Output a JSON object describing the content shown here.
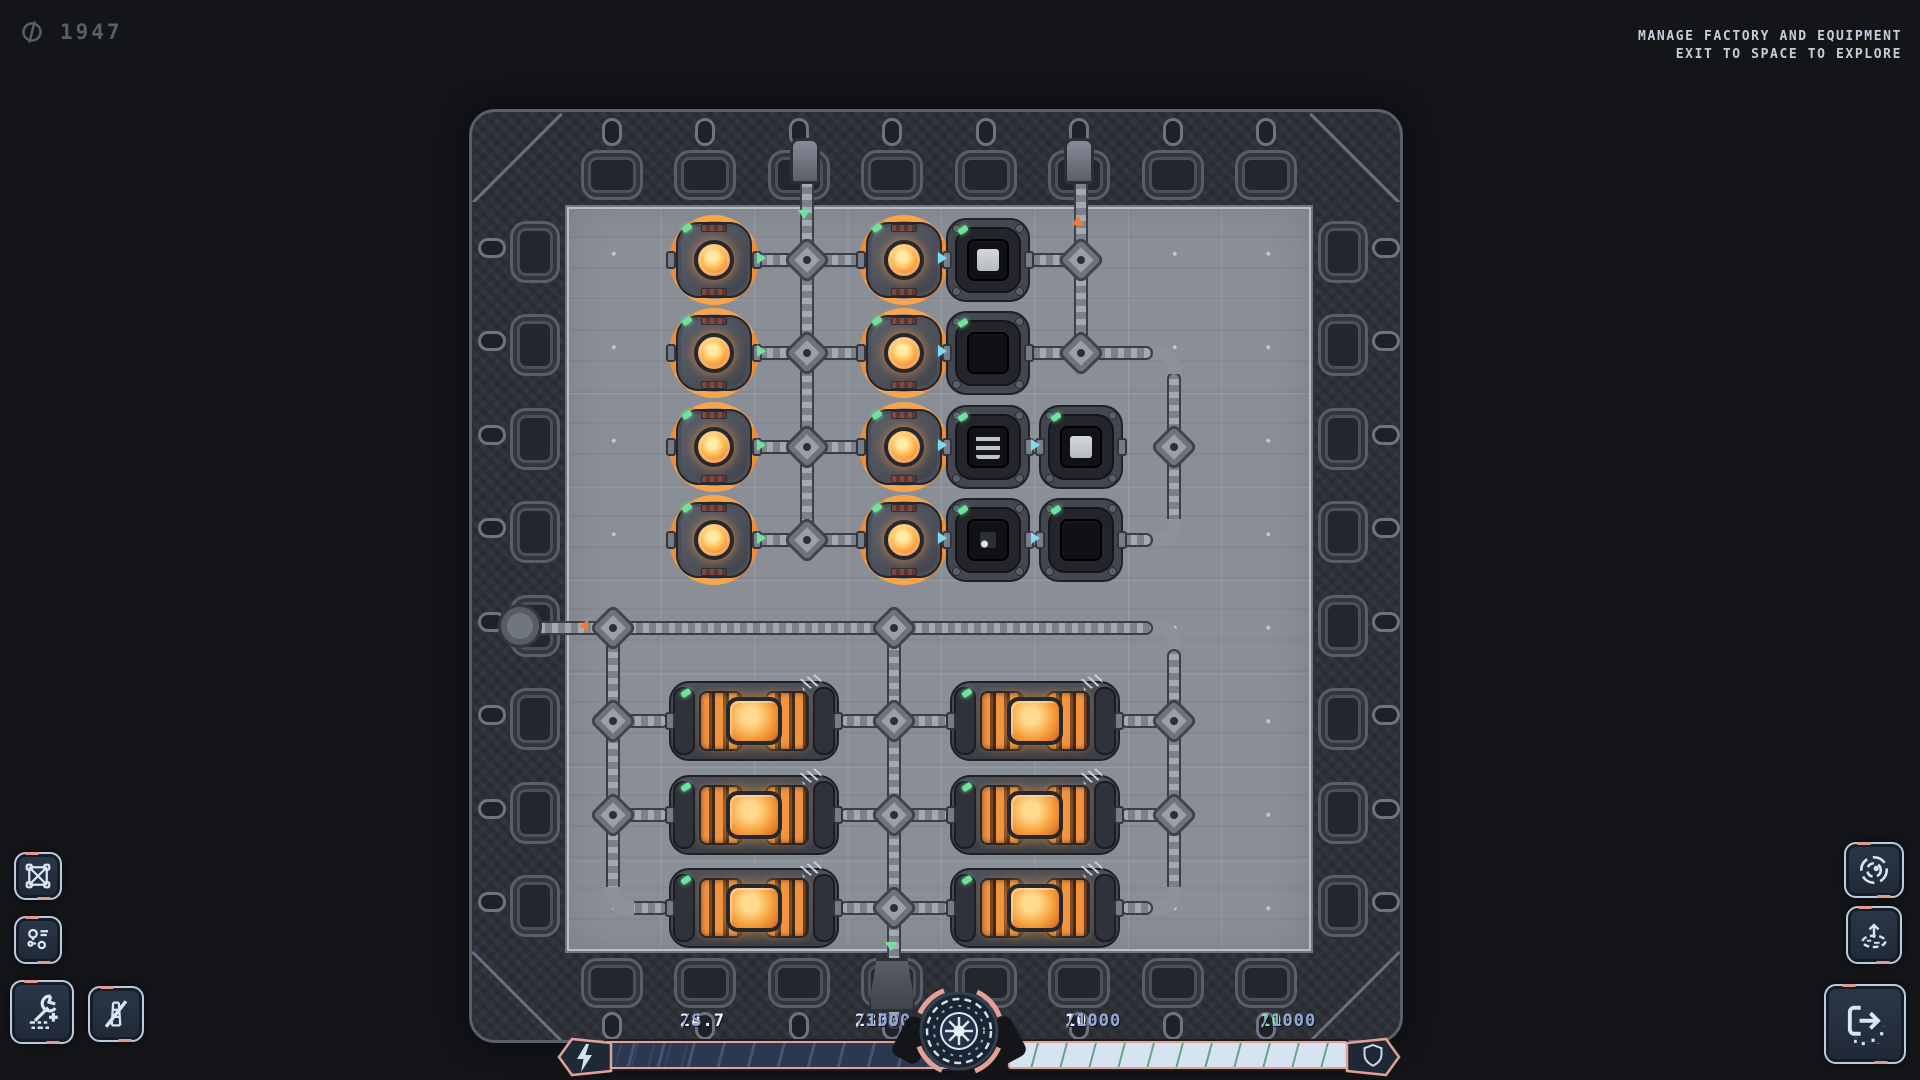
{
  "currency": {
    "value": "1947",
    "icon": "credits-icon"
  },
  "hints": {
    "line1": "MANAGE FACTORY AND EQUIPMENT",
    "line2": "EXIT TO SPACE TO EXPLORE"
  },
  "hud": {
    "stats": [
      {
        "value": "24.7",
        "denom": "/S"
      },
      {
        "value": "235",
        "denom": "/1000",
        "percent": 23.5
      },
      {
        "value": "1000",
        "denom": "/1000"
      },
      {
        "value": "1000",
        "denom": "/1000",
        "highlight": "green"
      }
    ],
    "energy_percent": 23.5,
    "shield_percent": 100,
    "colors": {
      "accent_pink": "#e2a195",
      "green": "#6fe39b",
      "cyan": "#7fd9ef",
      "orange": "#f2793c",
      "bar_dark": "#2a3950",
      "bar_light": "#d7e3f0"
    }
  },
  "left_toolbar": [
    {
      "icon": "crate-icon"
    },
    {
      "icon": "logistics-icon"
    },
    {
      "icon": "build-wrench-icon"
    },
    {
      "icon": "demolish-icon"
    }
  ],
  "right_toolbar": [
    {
      "icon": "orbit-icon"
    },
    {
      "icon": "terrain-raise-icon"
    },
    {
      "icon": "exit-to-space-icon"
    }
  ],
  "factory": {
    "machines": [
      {
        "type": "generator",
        "x": 240,
        "y": 146
      },
      {
        "type": "generator",
        "x": 430,
        "y": 146
      },
      {
        "type": "generator",
        "x": 240,
        "y": 239
      },
      {
        "type": "generator",
        "x": 430,
        "y": 239
      },
      {
        "type": "generator",
        "x": 240,
        "y": 333
      },
      {
        "type": "generator",
        "x": 430,
        "y": 333
      },
      {
        "type": "generator",
        "x": 240,
        "y": 426
      },
      {
        "type": "generator",
        "x": 430,
        "y": 426
      },
      {
        "type": "container",
        "x": 514,
        "y": 146,
        "core": "full"
      },
      {
        "type": "container",
        "x": 514,
        "y": 239,
        "core": "empty"
      },
      {
        "type": "container",
        "x": 514,
        "y": 333,
        "core": "striped"
      },
      {
        "type": "container",
        "x": 607,
        "y": 333,
        "core": "full"
      },
      {
        "type": "container",
        "x": 514,
        "y": 426,
        "core": "dim"
      },
      {
        "type": "container",
        "x": 607,
        "y": 426,
        "core": "empty"
      },
      {
        "type": "coil",
        "x": 280,
        "y": 607
      },
      {
        "type": "coil",
        "x": 561,
        "y": 607
      },
      {
        "type": "coil",
        "x": 280,
        "y": 701
      },
      {
        "type": "coil",
        "x": 561,
        "y": 701
      },
      {
        "type": "coil",
        "x": 280,
        "y": 794
      },
      {
        "type": "coil",
        "x": 561,
        "y": 794
      }
    ],
    "pipes": [
      [
        326,
        30,
        14,
        396
      ],
      [
        600,
        30,
        14,
        209
      ],
      [
        278,
        139,
        329,
        14
      ],
      [
        278,
        232,
        401,
        14
      ],
      [
        278,
        326,
        371,
        14
      ],
      [
        278,
        419,
        401,
        14
      ],
      [
        693,
        258,
        14,
        158
      ],
      [
        50,
        507,
        629,
        14
      ],
      [
        693,
        535,
        14,
        247
      ],
      [
        413,
        514,
        14,
        401
      ],
      [
        132,
        514,
        14,
        266
      ],
      [
        153,
        787,
        42,
        14
      ],
      [
        646,
        787,
        33,
        14
      ],
      [
        146,
        600,
        49,
        14
      ],
      [
        146,
        694,
        49,
        14
      ],
      [
        365,
        600,
        111,
        14
      ],
      [
        365,
        694,
        111,
        14
      ],
      [
        365,
        787,
        111,
        14
      ],
      [
        646,
        600,
        47,
        14
      ],
      [
        646,
        694,
        47,
        14
      ]
    ],
    "corners": [
      {
        "x": 679,
        "y": 232,
        "t": "tr"
      },
      {
        "x": 679,
        "y": 405,
        "t": "br"
      },
      {
        "x": 679,
        "y": 507,
        "t": "tr"
      },
      {
        "x": 679,
        "y": 773,
        "t": "br"
      },
      {
        "x": 132,
        "y": 773,
        "t": "bl"
      }
    ],
    "junctions": [
      [
        333,
        146
      ],
      [
        333,
        239
      ],
      [
        333,
        333
      ],
      [
        333,
        426
      ],
      [
        607,
        146
      ],
      [
        607,
        239
      ],
      [
        700,
        333
      ],
      [
        139,
        514
      ],
      [
        420,
        514
      ],
      [
        139,
        607
      ],
      [
        139,
        701
      ],
      [
        420,
        607
      ],
      [
        420,
        701
      ],
      [
        420,
        794
      ],
      [
        700,
        607
      ],
      [
        700,
        701
      ]
    ],
    "arrows": [
      {
        "x": 292,
        "y": 146,
        "dir": "right",
        "c": "green"
      },
      {
        "x": 292,
        "y": 239,
        "dir": "right",
        "c": "green"
      },
      {
        "x": 292,
        "y": 333,
        "dir": "right",
        "c": "green"
      },
      {
        "x": 292,
        "y": 426,
        "dir": "right",
        "c": "green"
      },
      {
        "x": 473,
        "y": 146,
        "dir": "right",
        "c": "cyan"
      },
      {
        "x": 473,
        "y": 239,
        "dir": "right",
        "c": "cyan"
      },
      {
        "x": 473,
        "y": 333,
        "dir": "right",
        "c": "cyan"
      },
      {
        "x": 473,
        "y": 426,
        "dir": "right",
        "c": "cyan"
      },
      {
        "x": 566,
        "y": 333,
        "dir": "right",
        "c": "cyan"
      },
      {
        "x": 566,
        "y": 426,
        "dir": "right",
        "c": "cyan"
      },
      {
        "x": 333,
        "y": 104,
        "dir": "down",
        "c": "green"
      },
      {
        "x": 607,
        "y": 104,
        "dir": "up",
        "c": "orange"
      },
      {
        "x": 108,
        "y": 514,
        "dir": "left",
        "c": "orange"
      },
      {
        "x": 420,
        "y": 836,
        "dir": "down",
        "c": "green"
      }
    ],
    "ports": [
      {
        "side": "top",
        "x": 333
      },
      {
        "side": "top",
        "x": 607
      },
      {
        "side": "left",
        "y": 514
      },
      {
        "side": "bottom",
        "x": 420
      }
    ]
  }
}
